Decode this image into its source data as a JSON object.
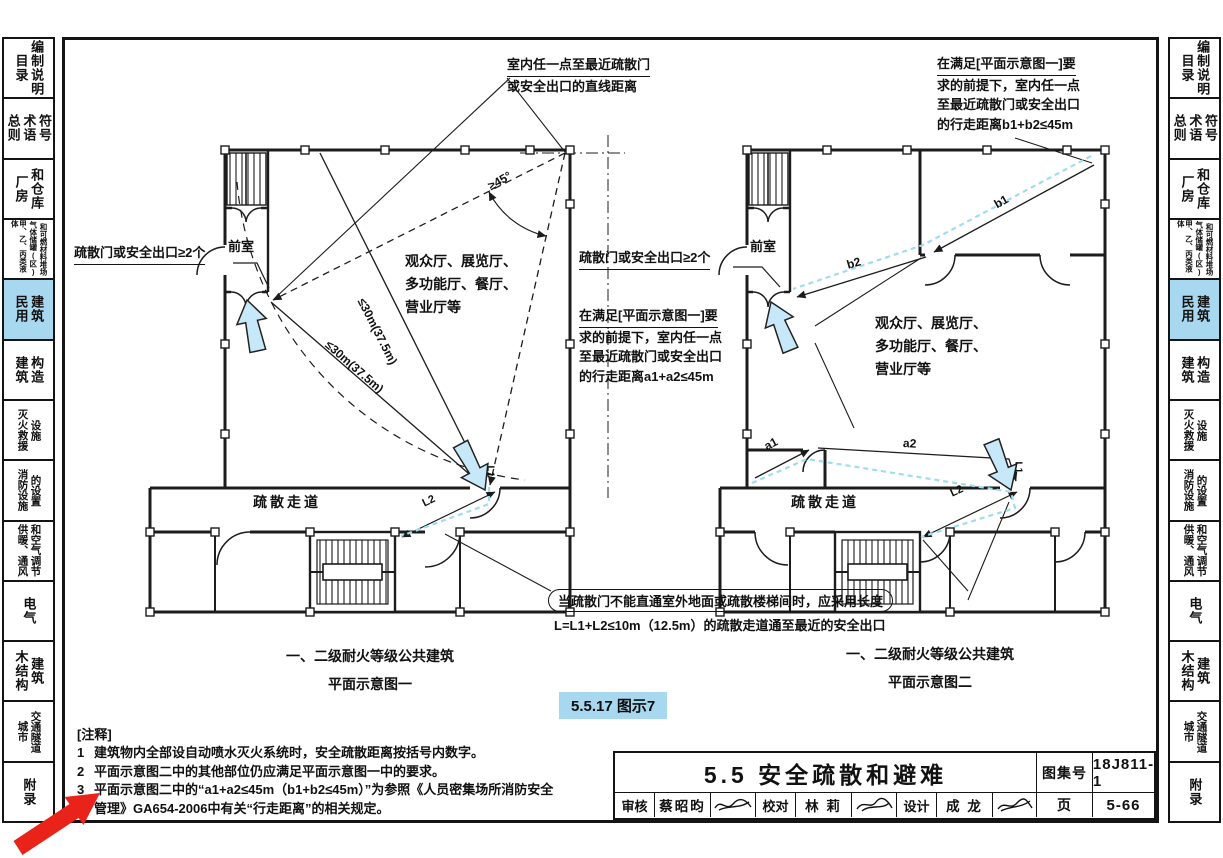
{
  "colors": {
    "highlight_blue": "#a7d8ef",
    "path_cyan": "#9edcee",
    "arrow_fill": "#c7e8f8",
    "red_annotation": "#e9231a",
    "line": "#1c1c1c"
  },
  "sidebar": {
    "tabs": [
      {
        "id": "catalog",
        "columns": [
          "目录",
          "编制说明"
        ]
      },
      {
        "id": "general-terms",
        "columns": [
          "总则",
          "术语",
          "符号"
        ]
      },
      {
        "id": "factory",
        "columns": [
          "厂房",
          "和仓库"
        ]
      },
      {
        "id": "tanks",
        "columns": [
          "甲、乙、丙类液体",
          "气体储罐(区)",
          "和可燃材料堆场"
        ]
      },
      {
        "id": "civil-active",
        "columns": [
          "民用",
          "建筑"
        ]
      },
      {
        "id": "construction",
        "columns": [
          "建筑",
          "构造"
        ]
      },
      {
        "id": "rescue",
        "columns": [
          "灭火救援",
          "设施"
        ]
      },
      {
        "id": "fire-equip",
        "columns": [
          "消防设施",
          "的设置"
        ]
      },
      {
        "id": "hvac",
        "columns": [
          "供暖、通风",
          "和空气调节"
        ]
      },
      {
        "id": "electrical",
        "columns": [
          "电气"
        ]
      },
      {
        "id": "timber",
        "columns": [
          "木结构",
          "建筑"
        ]
      },
      {
        "id": "tunnel",
        "columns": [
          "城市",
          "交通隧道"
        ]
      },
      {
        "id": "appendix",
        "columns": [
          "附录"
        ]
      }
    ]
  },
  "annotations": {
    "direct_distance": {
      "line1": "室内任一点至最近疏散门",
      "line2": "或安全出口的直线距离"
    },
    "walk_distance_b": {
      "line1": "在满足[平面示意图一]要",
      "line2": "求的前提下，室内任一点",
      "line3": "至最近疏散门或安全出口",
      "line4": "的行走距离b1+b2≤45m"
    },
    "walk_distance_a": {
      "line1": "在满足[平面示意图一]要",
      "line2": "求的前提下，室内任一点",
      "line3": "至最近疏散门或安全出口",
      "line4": "的行走距离a1+a2≤45m"
    },
    "exits_left": "疏散门或安全出口≥2个",
    "exits_mid": "疏散门或安全出口≥2个",
    "corridor_note_line1": "当疏散门不能直通室外地面或疏散楼梯间时，应采用长度",
    "corridor_note_line2": "L=L1+L2≤10m（12.5m）的疏散走道通至最近的安全出口"
  },
  "d_left": {
    "front_room": "前室",
    "corridor": "疏散走道",
    "dist_upper": "≤30m(37.5m)",
    "dist_lower": "≤30m(37.5m)",
    "angle": "≥45°",
    "l1": "L1",
    "l2": "L2",
    "room_lines": [
      "观众厅、展览厅、",
      "多功能厅、餐厅、",
      "营业厅等"
    ],
    "caption1": "一、二级耐火等级公共建筑",
    "caption2": "平面示意图一"
  },
  "d_right": {
    "front_room": "前室",
    "corridor": "疏散走道",
    "b1": "b1",
    "b2": "b2",
    "a1": "a1",
    "a2": "a2",
    "l1": "L1",
    "l2": "L2",
    "room_lines": [
      "观众厅、展览厅、",
      "多功能厅、餐厅、",
      "营业厅等"
    ],
    "caption1": "一、二级耐火等级公共建筑",
    "caption2": "平面示意图二"
  },
  "figure_badge": "5.5.17 图示7",
  "notes": {
    "header": "[注释]",
    "items": [
      {
        "no": "1",
        "text": "建筑物内全部设自动喷水灭火系统时，安全疏散距离按括号内数字。"
      },
      {
        "no": "2",
        "text": "平面示意图二中的其他部位仍应满足平面示意图一中的要求。"
      },
      {
        "no": "3",
        "text": "平面示意图二中的“a1+a2≤45m（b1+b2≤45m）”为参照《人员密集场所消防安全管理》GA654-2006中有关“行走距离”的相关规定。"
      }
    ]
  },
  "title_block": {
    "section_title": "5.5 安全疏散和避难",
    "atlas_no_label": "图集号",
    "atlas_no": "18J811-1",
    "page_label": "页",
    "page_no": "5-66",
    "reviewer_label": "审核",
    "reviewer": "蔡昭昀",
    "checker_label": "校对",
    "checker": "林 莉",
    "designer_label": "设计",
    "designer": "成 龙"
  }
}
